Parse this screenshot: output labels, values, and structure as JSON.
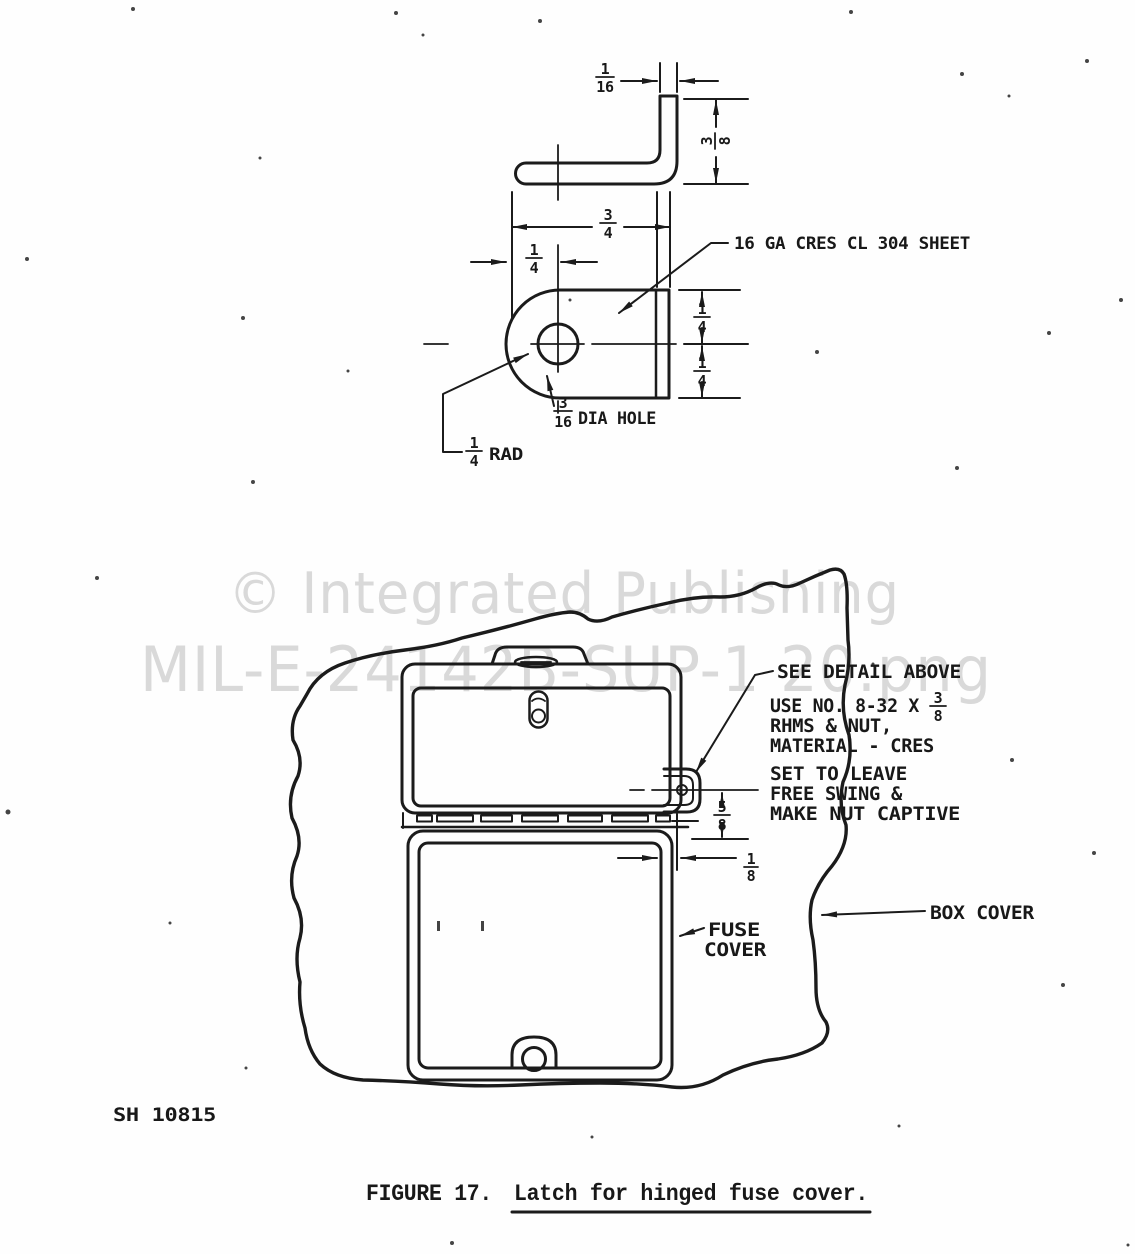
{
  "watermark": {
    "line1": "© Integrated Publishing",
    "line2": "MIL-E-24142B-SUP-1 20.png"
  },
  "detail_view": {
    "material_note": "16 GA CRES CL 304 SHEET",
    "thickness": {
      "num": "1",
      "den": "16"
    },
    "leg_height": {
      "num": "3",
      "den": "8"
    },
    "width": {
      "num": "3",
      "den": "4"
    },
    "hole_offset": {
      "num": "1",
      "den": "4"
    },
    "upper_half": {
      "num": "1",
      "den": "4"
    },
    "lower_half": {
      "num": "1",
      "den": "4"
    },
    "hole_dim": {
      "num": "3",
      "den": "16",
      "label": "DIA HOLE"
    },
    "radius_dim": {
      "num": "1",
      "den": "4",
      "label": "RAD"
    }
  },
  "assembly_view": {
    "see_detail_note": "SEE DETAIL ABOVE",
    "hardware_note_line1": "USE NO. 8-32 X",
    "hardware_fraction": {
      "num": "3",
      "den": "8"
    },
    "hardware_note_line2": "RHMS & NUT,",
    "hardware_note_line3": "MATERIAL - CRES",
    "setting_note_line1": "SET TO LEAVE",
    "setting_note_line2": "FREE SWING &",
    "setting_note_line3": "MAKE NUT CAPTIVE",
    "latch_offset": {
      "num": "5",
      "den": "8"
    },
    "edge_gap": {
      "num": "1",
      "den": "8"
    },
    "fuse_cover_label_line1": "FUSE",
    "fuse_cover_label_line2": "COVER",
    "box_cover_label": "BOX COVER"
  },
  "footer": {
    "sheet_number": "SH 10815",
    "figure_label": "FIGURE 17.",
    "figure_title": "Latch for hinged fuse cover."
  }
}
